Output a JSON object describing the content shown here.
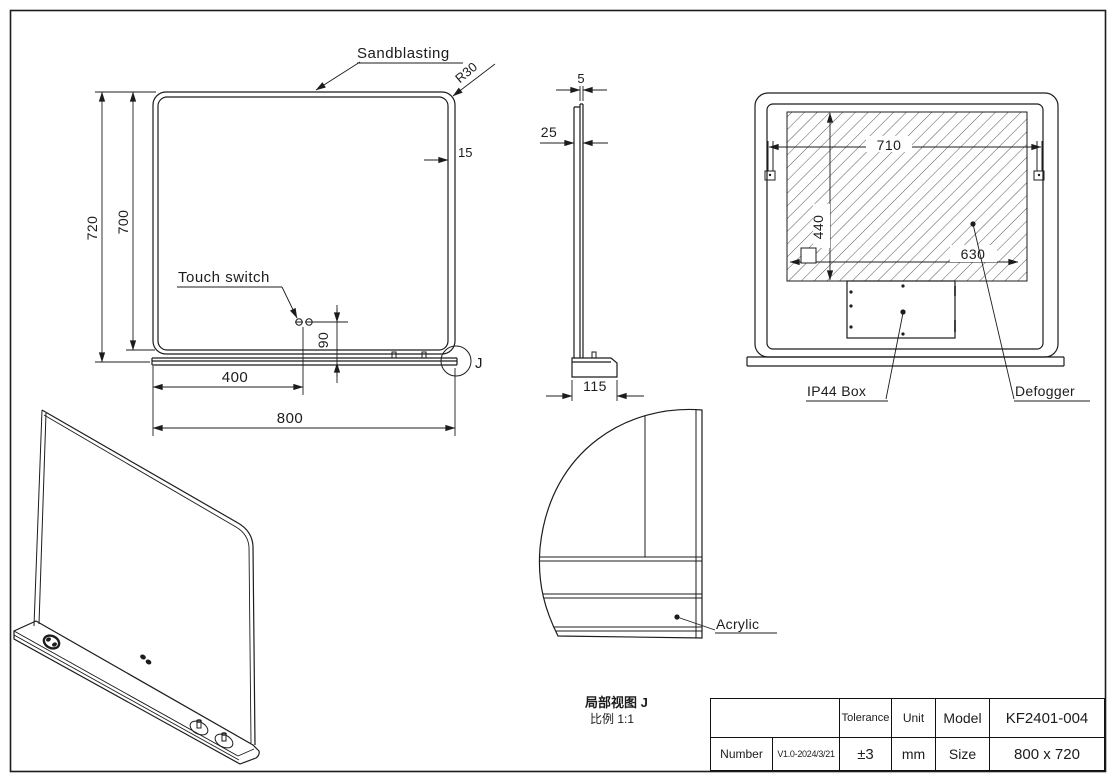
{
  "front": {
    "sandblasting": "Sandblasting",
    "r30": "R30",
    "frame_width": "15",
    "height_total": "720",
    "height_glass": "700",
    "touch_switch": "Touch switch",
    "switch_height": "90",
    "switch_offset": "400",
    "width_total": "800",
    "detail_marker": "J"
  },
  "side": {
    "glass_thickness": "5",
    "depth": "25",
    "base_depth": "115"
  },
  "back": {
    "defogger_width_top": "710",
    "defogger_height": "440",
    "defogger_width_bottom": "630",
    "ip44_box": "IP44  Box",
    "defogger": "Defogger"
  },
  "detail": {
    "acrylic": "Acrylic",
    "title": "局部视图 J",
    "scale": "比例 1:1"
  },
  "title_block": {
    "tolerance_label": "Tolerance",
    "tolerance": "±3",
    "unit_label": "Unit",
    "unit": "mm",
    "model_label": "Model",
    "model": "KF2401-004",
    "number_label": "Number",
    "number": "V1.0-2024/3/21",
    "size_label": "Size",
    "size": "800 x 720"
  },
  "colors": {
    "line": "#1c1c1c",
    "background": "#ffffff"
  }
}
